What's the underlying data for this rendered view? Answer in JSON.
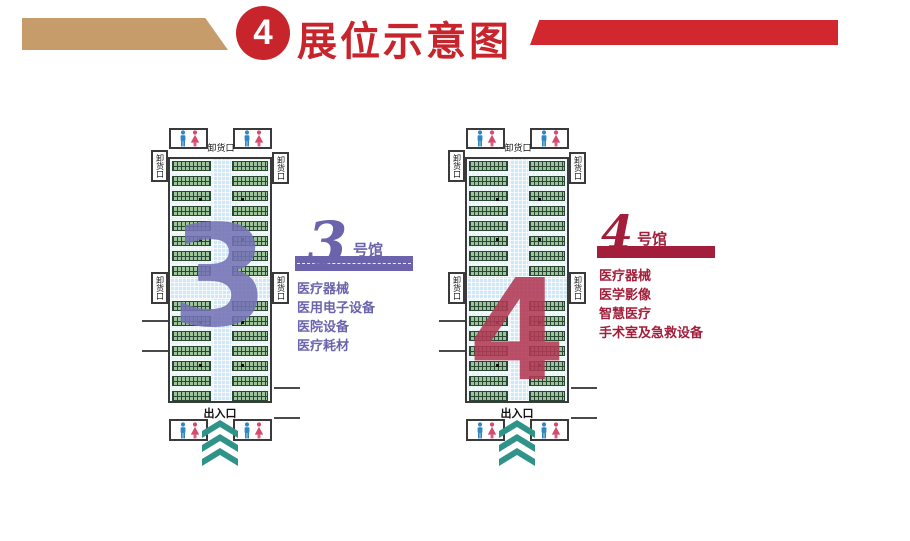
{
  "header": {
    "badge_number": "4",
    "title": "展位示意图"
  },
  "halls": [
    {
      "number": "3",
      "suffix": "号馆",
      "accent": "#6b63ac",
      "big_number_color": "#7573b6",
      "unloading_label": "卸货口",
      "entrance_label": "出入口",
      "categories": [
        "医疗器械",
        "医用电子设备",
        "医院设备",
        "医疗耗材"
      ]
    },
    {
      "number": "4",
      "suffix": "号馆",
      "accent": "#a31e3b",
      "big_number_color": "#b23a55",
      "unloading_label": "卸货口",
      "entrance_label": "出入口",
      "categories": [
        "医疗器械",
        "医学影像",
        "智慧医疗",
        "手术室及急救设备"
      ]
    }
  ],
  "colors": {
    "title_red": "#c8242b",
    "ribbon_tan": "#c79c6b",
    "ribbon_red": "#d2272e",
    "booth_green": "#9cc39a",
    "aisle_blue": "#cfe7f6",
    "chevron_teal": "#2f9389",
    "male_blue": "#2e86c4",
    "female_pink": "#d64a6e"
  }
}
